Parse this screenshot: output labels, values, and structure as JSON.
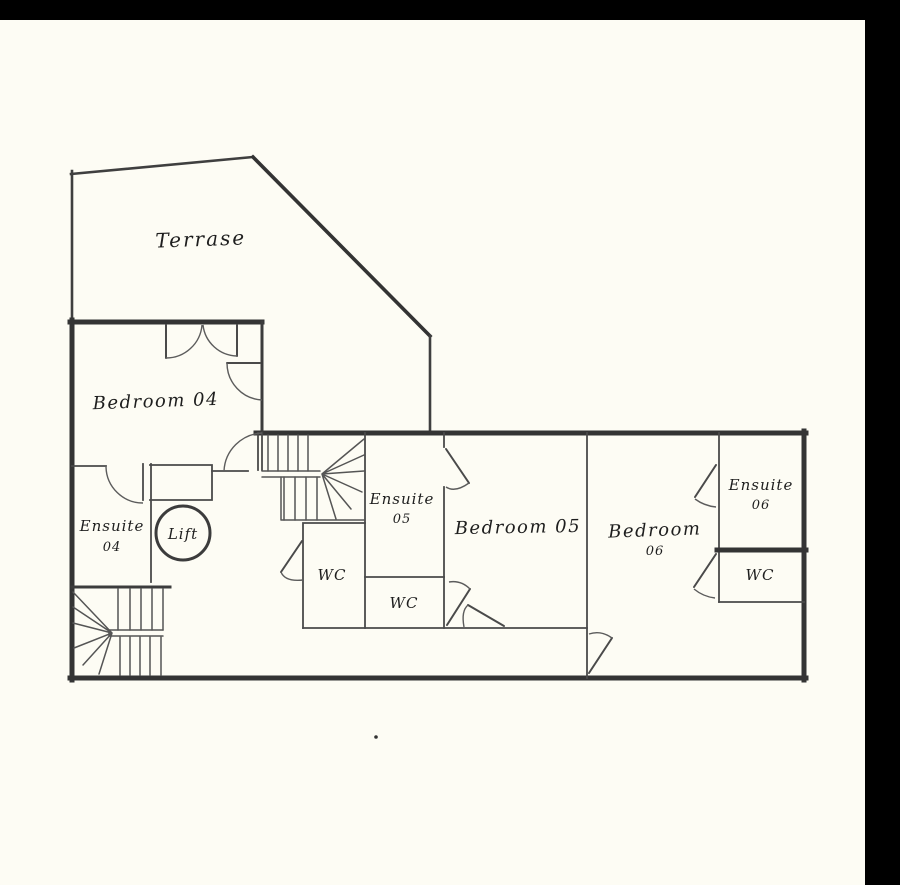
{
  "frame": {
    "background_color": "#000000",
    "page_color": "#fdfcf4",
    "ink_color": "#3c3c3c"
  },
  "floorplan": {
    "rooms": {
      "terrace": {
        "label": "Terrase"
      },
      "bedroom04": {
        "label": "Bedroom 04"
      },
      "ensuite04": {
        "line1": "Ensuite",
        "line2": "04"
      },
      "lift": {
        "label": "Lift"
      },
      "ensuite05": {
        "line1": "Ensuite",
        "line2": "05"
      },
      "wc_left": {
        "label": "WC"
      },
      "wc_middle": {
        "label": "WC"
      },
      "bedroom05": {
        "label": "Bedroom 05"
      },
      "bedroom06": {
        "line1": "Bedroom",
        "line2": "06"
      },
      "ensuite06": {
        "line1": "Ensuite",
        "line2": "06"
      },
      "wc_right": {
        "label": "WC"
      }
    }
  }
}
